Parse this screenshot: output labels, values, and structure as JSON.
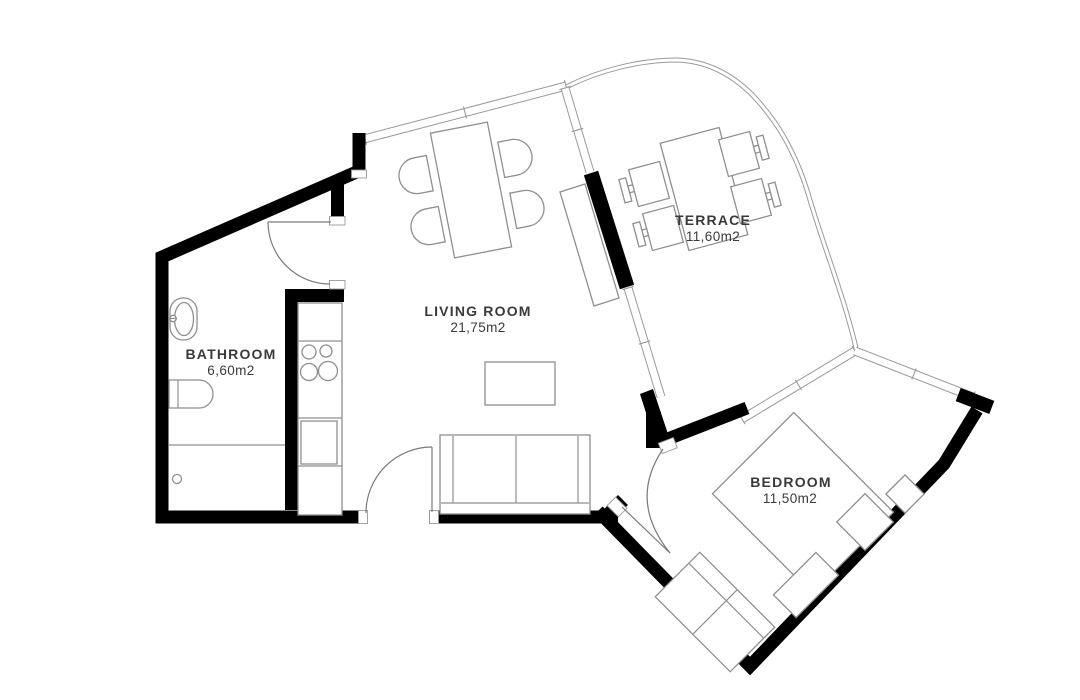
{
  "rooms": {
    "living": {
      "name": "LIVING ROOM",
      "area": "21,75m2"
    },
    "terrace": {
      "name": "TERRACE",
      "area": "11,60m2"
    },
    "bathroom": {
      "name": "BATHROOM",
      "area": "6,60m2"
    },
    "bedroom": {
      "name": "BEDROOM",
      "area": "11,50m2"
    }
  },
  "colors": {
    "wall": "#000000",
    "drawing_line": "#8f8f8f",
    "window_line": "#9a9a9a",
    "label_text": "#3a3a3a",
    "background": "#ffffff"
  }
}
